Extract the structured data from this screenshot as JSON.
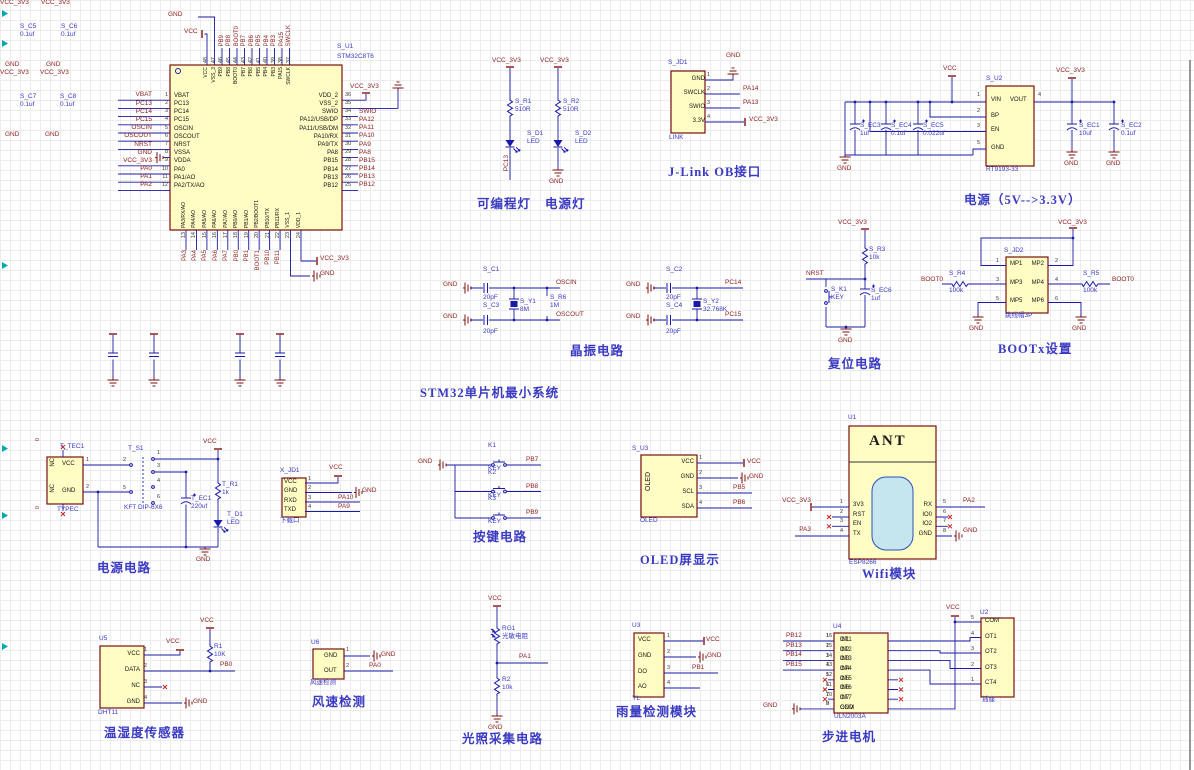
{
  "colors": {
    "wire": "#1a1aa8",
    "net_label": "#8c1f1f",
    "designator": "#3a3ac2",
    "component_fill": "#fffdc4",
    "component_border": "#7a1010",
    "caption": "#3a3ac2",
    "nc_mark": "#c42222",
    "edge_marker": "#00a8b0",
    "wifi_core_fill": "#c5e6ee"
  },
  "mcu": {
    "designator": "S_U1",
    "part": "STM32C8T6",
    "caption": "STM32单片机最小系统",
    "top_gnd": "GND",
    "top_vcc": "VCC",
    "right_vcc": "VCC_3V3",
    "right_num36": "36",
    "bottom_gnd": "GND",
    "bottom_vcc": "VCC_3V3",
    "left": [
      {
        "num": "1",
        "name": "VBAT",
        "net": "VBAT"
      },
      {
        "num": "2",
        "name": "PC13",
        "net": "PC13"
      },
      {
        "num": "3",
        "name": "PC14",
        "net": "PC14"
      },
      {
        "num": "4",
        "name": "PC15",
        "net": "PC15"
      },
      {
        "num": "5",
        "name": "OSCIN",
        "net": "OSCIN"
      },
      {
        "num": "6",
        "name": "OSCOUT",
        "net": "OSCOUT"
      },
      {
        "num": "7",
        "name": "NRST",
        "net": "NRST"
      },
      {
        "num": "8",
        "name": "VSSA",
        "net": "GND"
      },
      {
        "num": "9",
        "name": "VDDA",
        "net": "VCC_3V3"
      },
      {
        "num": "10",
        "name": "PA0",
        "net": "PA0"
      },
      {
        "num": "11",
        "name": "PA1/AO",
        "net": "PA1"
      },
      {
        "num": "12",
        "name": "PA2/TX/AO",
        "net": "PA2"
      }
    ],
    "right": [
      {
        "num": "36",
        "name": "VDD_2",
        "net": ""
      },
      {
        "num": "35",
        "name": "VSS_2",
        "net": ""
      },
      {
        "num": "34",
        "name": "SWIO",
        "net": "SWIO"
      },
      {
        "num": "33",
        "name": "PA12/USB/DP",
        "net": "PA12"
      },
      {
        "num": "32",
        "name": "PA11/USB/DM",
        "net": "PA11"
      },
      {
        "num": "31",
        "name": "PA10/RX",
        "net": "PA10"
      },
      {
        "num": "30",
        "name": "PA9/TX",
        "net": "PA9"
      },
      {
        "num": "29",
        "name": "PA8",
        "net": "PA8"
      },
      {
        "num": "28",
        "name": "PB15",
        "net": "PB15"
      },
      {
        "num": "27",
        "name": "PB14",
        "net": "PB14"
      },
      {
        "num": "26",
        "name": "PB13",
        "net": "PB13"
      },
      {
        "num": "25",
        "name": "PB12",
        "net": "PB12"
      }
    ],
    "top": [
      {
        "num": "48",
        "name": "VCC",
        "net": ""
      },
      {
        "num": "47",
        "name": "VSS_3",
        "net": ""
      },
      {
        "num": "46",
        "name": "PB9",
        "net": "PB9"
      },
      {
        "num": "45",
        "name": "PB8",
        "net": "PB8"
      },
      {
        "num": "44",
        "name": "BOOT0",
        "net": "BOOT0"
      },
      {
        "num": "43",
        "name": "PB7",
        "net": "PB7"
      },
      {
        "num": "42",
        "name": "PB6",
        "net": "PB6"
      },
      {
        "num": "41",
        "name": "PB5",
        "net": "PB5"
      },
      {
        "num": "40",
        "name": "PB4",
        "net": "PB4"
      },
      {
        "num": "39",
        "name": "PB3",
        "net": "PB3"
      },
      {
        "num": "38",
        "name": "PA15",
        "net": "PA15"
      },
      {
        "num": "37",
        "name": "SWCLK",
        "net": "SWCLK"
      }
    ],
    "bottom": [
      {
        "num": "13",
        "name": "PA3/RX/AO",
        "net": "PA3"
      },
      {
        "num": "14",
        "name": "PA4/AO",
        "net": "PA4"
      },
      {
        "num": "15",
        "name": "PA5/AO",
        "net": "PA5"
      },
      {
        "num": "16",
        "name": "PA6/AO",
        "net": "PA6"
      },
      {
        "num": "17",
        "name": "PA7/AO",
        "net": "PA7"
      },
      {
        "num": "18",
        "name": "PB0/AO",
        "net": "PB0"
      },
      {
        "num": "19",
        "name": "PB1/AO",
        "net": "PB1"
      },
      {
        "num": "20",
        "name": "PB2/BOOT1",
        "net": "BOOT1"
      },
      {
        "num": "21",
        "name": "PB10/TX",
        "net": "PB10"
      },
      {
        "num": "22",
        "name": "PB11/RX",
        "net": "PB11"
      },
      {
        "num": "23",
        "name": "VSS_1",
        "net": ""
      },
      {
        "num": "24",
        "name": "VDD_1",
        "net": ""
      }
    ]
  },
  "decoupling": {
    "group1": [
      {
        "vcc": "VCC_3V3",
        "ref": "S_C5",
        "val": "0.1uf",
        "gnd": "GND"
      },
      {
        "vcc": "VCC_3V3",
        "ref": "S_C6",
        "val": "0.1uf",
        "gnd": "GND"
      }
    ],
    "group2": [
      {
        "vcc": "VCC_3V3",
        "ref": "S_C7",
        "val": "0.1uf",
        "gnd": "GND"
      },
      {
        "vcc": "VCC_3V3",
        "ref": "S_C8",
        "val": "0.1uf",
        "gnd": "GND"
      }
    ]
  },
  "prog_led": {
    "vcc": "VCC_3V3",
    "r_ref": "S_R1",
    "r_val": "510R",
    "d_ref": "S_D1",
    "d_val": "LED",
    "net": "PC13",
    "caption": "可编程灯"
  },
  "pwr_led": {
    "vcc": "VCC_3V3",
    "r_ref": "S_R2",
    "r_val": "510R",
    "d_ref": "S_D2",
    "d_val": "LED",
    "gnd": "GND",
    "caption": "电源灯"
  },
  "jlink": {
    "ref": "S_JD1",
    "name": "LINK",
    "caption": "J-Link OB接口",
    "gnd": "GND",
    "vcc": "VCC_3V3",
    "pins": [
      {
        "num": "1",
        "name": "GND",
        "net": ""
      },
      {
        "num": "2",
        "name": "SWCLK",
        "net": "PA14"
      },
      {
        "num": "3",
        "name": "SWIO",
        "net": "PA13"
      },
      {
        "num": "4",
        "name": "3.3V",
        "net": ""
      }
    ]
  },
  "regulator": {
    "ref": "S_U2",
    "part": "RT9193-33",
    "caption": "电源（5V-->3.3V）",
    "vin": "VCC",
    "vout": "VCC_3V3",
    "pin_vin": "VIN",
    "pin_vout": "VOUT",
    "pin_bp": "BP",
    "pin_en": "EN",
    "pin_gnd": "GND",
    "num_vin": "1",
    "num_bp": "2",
    "num_en": "3",
    "num_gnd": "5",
    "num_vout": "4",
    "in_caps": [
      {
        "ref": "S_EC3",
        "val": "1uf"
      },
      {
        "ref": "S_EC4",
        "val": "0.1uf"
      },
      {
        "ref": "S_EC5",
        "val": "0.022uf"
      }
    ],
    "out_caps": [
      {
        "ref": "S_EC1",
        "val": "10uf"
      },
      {
        "ref": "S_EC2",
        "val": "0.1uf"
      }
    ],
    "gnd1": "GND",
    "gnd2": "GND",
    "gnd3": "GND"
  },
  "xtal1": {
    "gnd1": "GND",
    "gnd2": "GND",
    "c1_ref": "S_C1",
    "c1_val": "20pF",
    "c2_ref": "S_C3",
    "c2_val": "20pF",
    "y_ref": "S_Y1",
    "y_val": "8M",
    "r_ref": "S_R6",
    "r_val": "1M",
    "net1": "OSCIN",
    "net2": "OSCOUT",
    "caption": "晶振电路"
  },
  "xtal2": {
    "gnd1": "GND",
    "gnd2": "GND",
    "c1_ref": "S_C2",
    "c1_val": "20pF",
    "c2_ref": "S_C4",
    "c2_val": "20pF",
    "y_ref": "S_Y2",
    "y_val": "32.768K",
    "net1": "PC14",
    "net2": "PC15"
  },
  "reset": {
    "vcc": "VCC_3V3",
    "r_ref": "S_R3",
    "r_val": "10k",
    "net": "NRST",
    "k_ref": "S_K1",
    "k_val": "KEY",
    "c_ref": "S_EC6",
    "c_val": "1uf",
    "gnd": "GND",
    "caption": "复位电路"
  },
  "bootx": {
    "ref": "S_JD2",
    "part": "跳线帽3P",
    "caption": "BOOTx设置",
    "vcc": "VCC_3V3",
    "rows": [
      {
        "ln": "1",
        "l": "MP1",
        "r": "MP2",
        "rn": "2"
      },
      {
        "ln": "3",
        "l": "MP3",
        "r": "MP4",
        "rn": "4"
      },
      {
        "ln": "5",
        "l": "MP5",
        "r": "MP6",
        "rn": "6"
      }
    ],
    "rl_ref": "S_R4",
    "rl_val": "100k",
    "rl_net": "BOOT0",
    "rr_ref": "S_R5",
    "rr_val": "100k",
    "rr_net": "BOOT0",
    "gnd1": "GND",
    "gnd2": "GND"
  },
  "typec": {
    "ref": "T_TEC1",
    "part": "TYPEC",
    "caption": "电源电路",
    "pin_nc1": "NC",
    "pin_vcc": "VCC",
    "pin_nc2": "NC",
    "pin_gnd": "GND",
    "num1": "1",
    "num2": "2",
    "zero1": "0",
    "zero2": "0",
    "sw_ref": "T_S1",
    "sw_part": "KFT DIP-6X6",
    "sw_nums": [
      "1",
      "2",
      "3",
      "4",
      "5",
      "6"
    ],
    "cap_ref": "T_EC1",
    "cap_val": "220uf",
    "r_ref": "T_R1",
    "r_val": "1k",
    "d_ref": "T_D1",
    "d_val": "LED",
    "vcc": "VCC",
    "gnd": "GND"
  },
  "download": {
    "ref": "X_JD1",
    "name": "下载口",
    "vcc": "VCC",
    "gnd": "GND",
    "pins": [
      {
        "num": "1",
        "name": "VCC",
        "net": ""
      },
      {
        "num": "2",
        "name": "GND",
        "net": ""
      },
      {
        "num": "3",
        "name": "RXD",
        "net": "PA10"
      },
      {
        "num": "4",
        "name": "TXD",
        "net": "PA9"
      }
    ]
  },
  "keys": {
    "caption": "按键电路",
    "gnd": "GND",
    "items": [
      {
        "ref": "K1",
        "val": "KEY",
        "net": "PB7"
      },
      {
        "ref": "K2",
        "val": "KEY",
        "net": "PB8"
      },
      {
        "ref": "K3",
        "val": "KEY",
        "net": "PB9"
      }
    ]
  },
  "oled": {
    "ref": "S_U3",
    "name": "OLED",
    "body": "OLED",
    "caption": "OLED屏显示",
    "vcc": "VCC",
    "gnd": "GND",
    "pins": [
      {
        "num": "1",
        "name": "VCC",
        "net": ""
      },
      {
        "num": "2",
        "name": "GND",
        "net": ""
      },
      {
        "num": "3",
        "name": "SCL",
        "net": "PB5"
      },
      {
        "num": "4",
        "name": "SDA",
        "net": "PB6"
      }
    ]
  },
  "wifi": {
    "ref": "U1",
    "part": "ESP8266",
    "ant": "ANT",
    "caption": "Wifi模块",
    "left": [
      {
        "num": "1",
        "name": "3V3",
        "net": "VCC_3V3"
      },
      {
        "num": "2",
        "name": "RST",
        "net": "",
        "nc": true
      },
      {
        "num": "3",
        "name": "EN",
        "net": "",
        "nc": true
      },
      {
        "num": "4",
        "name": "TX",
        "net": "PA3"
      }
    ],
    "right": [
      {
        "num": "5",
        "name": "RX",
        "net": "PA2"
      },
      {
        "num": "6",
        "name": "IO0",
        "net": "",
        "nc": true
      },
      {
        "num": "7",
        "name": "IO2",
        "net": "",
        "nc": true
      },
      {
        "num": "8",
        "name": "GND",
        "net": "",
        "gnet": "GND"
      }
    ]
  },
  "dht": {
    "ref": "U5",
    "part": "DHT11",
    "caption": "温湿度传感器",
    "vcc1": "VCC",
    "vcc2": "VCC",
    "r_ref": "R1",
    "r_val": "10K",
    "net": "PB0",
    "gnd": "GND",
    "pins": [
      {
        "num": "1",
        "name": "VCC"
      },
      {
        "num": "2",
        "name": "DATA"
      },
      {
        "num": "3",
        "name": "NC"
      },
      {
        "num": "4",
        "name": "GND"
      }
    ]
  },
  "wind": {
    "ref": "U6",
    "name": "风速检测",
    "caption": "风速检测",
    "gnd": "GND",
    "net": "PA0",
    "pins": [
      {
        "num": "1",
        "name": "GND"
      },
      {
        "num": "2",
        "name": "OUT"
      }
    ]
  },
  "light": {
    "vcc": "VCC",
    "rg_ref": "RG1",
    "rg_val": "光敏电阻",
    "net": "PA1",
    "r_ref": "R2",
    "r_val": "10k",
    "gnd": "GND",
    "caption": "光照采集电路"
  },
  "rain": {
    "ref": "U3",
    "name": "YL",
    "caption": "雨量检测模块",
    "vcc": "VCC",
    "gnd": "GND",
    "pins": [
      {
        "num": "1",
        "name": "VCC",
        "net": ""
      },
      {
        "num": "2",
        "name": "GND",
        "net": ""
      },
      {
        "num": "3",
        "name": "DO",
        "net": "PB1"
      },
      {
        "num": "4",
        "name": "AO",
        "net": ""
      }
    ]
  },
  "stepper": {
    "ref": "U4",
    "part": "ULN2003A",
    "caption": "步进电机",
    "vcc": "VCC",
    "rows": [
      {
        "ln": "1",
        "l": "IN1",
        "rn": "16",
        "r": "OT1",
        "net": "PB12"
      },
      {
        "ln": "2",
        "l": "IN2",
        "rn": "15",
        "r": "OT2",
        "net": "PB13"
      },
      {
        "ln": "3",
        "l": "IN3",
        "rn": "14",
        "r": "OT3",
        "net": "PB14"
      },
      {
        "ln": "4",
        "l": "IN4",
        "rn": "13",
        "r": "OT4",
        "net": "PB15"
      },
      {
        "ln": "5",
        "l": "IN5",
        "rn": "12",
        "r": "OT5",
        "nc": true
      },
      {
        "ln": "6",
        "l": "IN6",
        "rn": "11",
        "r": "OT6",
        "nc": true
      },
      {
        "ln": "7",
        "l": "IN7",
        "rn": "10",
        "r": "OT7",
        "nc": true
      },
      {
        "ln": "8",
        "l": "GND",
        "rn": "9",
        "r": "COM",
        "gnet": "GND"
      }
    ],
    "conn": {
      "ref": "U2",
      "name": "插座",
      "pins": [
        {
          "num": "5",
          "name": "COM"
        },
        {
          "num": "4",
          "name": "OT1"
        },
        {
          "num": "3",
          "name": "OT2"
        },
        {
          "num": "2",
          "name": "OT3"
        },
        {
          "num": "1",
          "name": "CT4"
        }
      ]
    }
  }
}
